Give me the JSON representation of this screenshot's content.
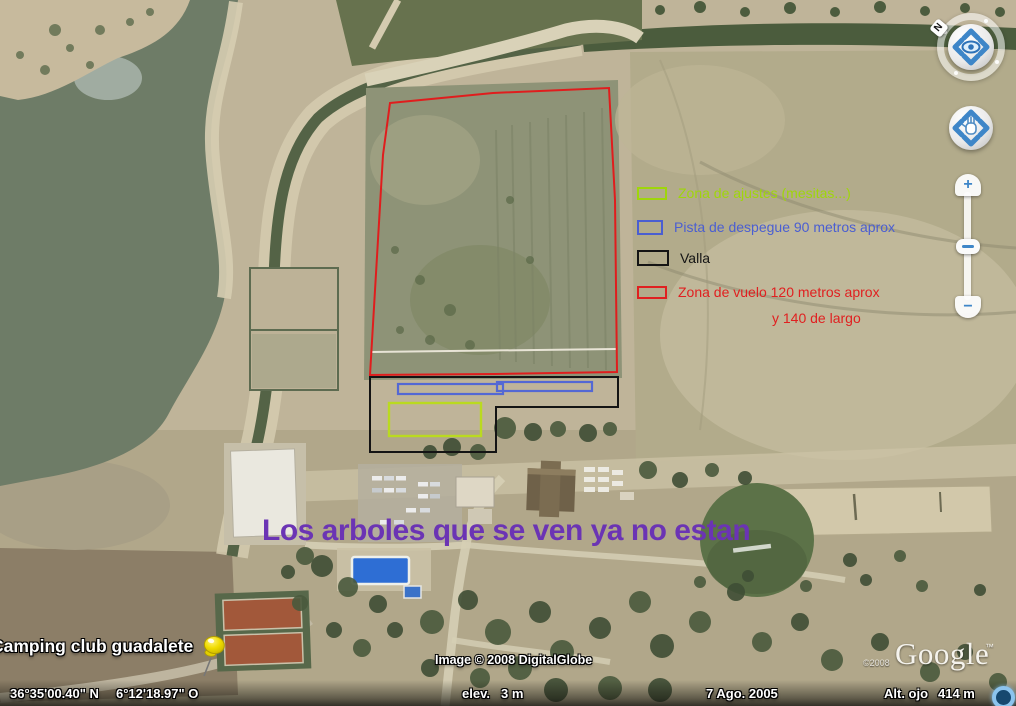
{
  "legend": {
    "items": [
      {
        "label": "Zona de ajustes (mesitas...)",
        "color": "#9fd60a"
      },
      {
        "label": "Pista de despegue 90 metros aprox",
        "color": "#4a5ed2"
      },
      {
        "label": "Valla",
        "color": "#141414"
      },
      {
        "label": "Zona de vuelo 120 metros aprox",
        "color": "#e02020"
      }
    ],
    "flight_zone_line2": "y 140 de largo"
  },
  "annotation": {
    "title": "Los arboles que se ven ya no estan",
    "title_color": "#6b34b4"
  },
  "placemark": {
    "label": "Camping club guadalete"
  },
  "overlays": {
    "flight_zone": {
      "color": "#e01d1d"
    },
    "fence": {
      "color": "#141414"
    },
    "runway": {
      "color": "#5468d4"
    },
    "adjustment_zone": {
      "color": "#bada20"
    }
  },
  "nav": {
    "north_label": "N",
    "zoom_in_label": "+",
    "zoom_out_label": "−"
  },
  "status_bar": {
    "latitude": "36°35'00.40\" N",
    "longitude": "6°12'18.97\" O",
    "elevation_label": "elev.",
    "elevation_value": "3 m",
    "imagery_date": "7 Ago. 2005",
    "eye_alt_label": "Alt. ojo",
    "eye_alt_value": "414 m"
  },
  "attribution": {
    "imagery_credit": "Image © 2008 DigitalGlobe",
    "logo_year": "©2008",
    "logo_text": "Google",
    "logo_tm": "™"
  }
}
